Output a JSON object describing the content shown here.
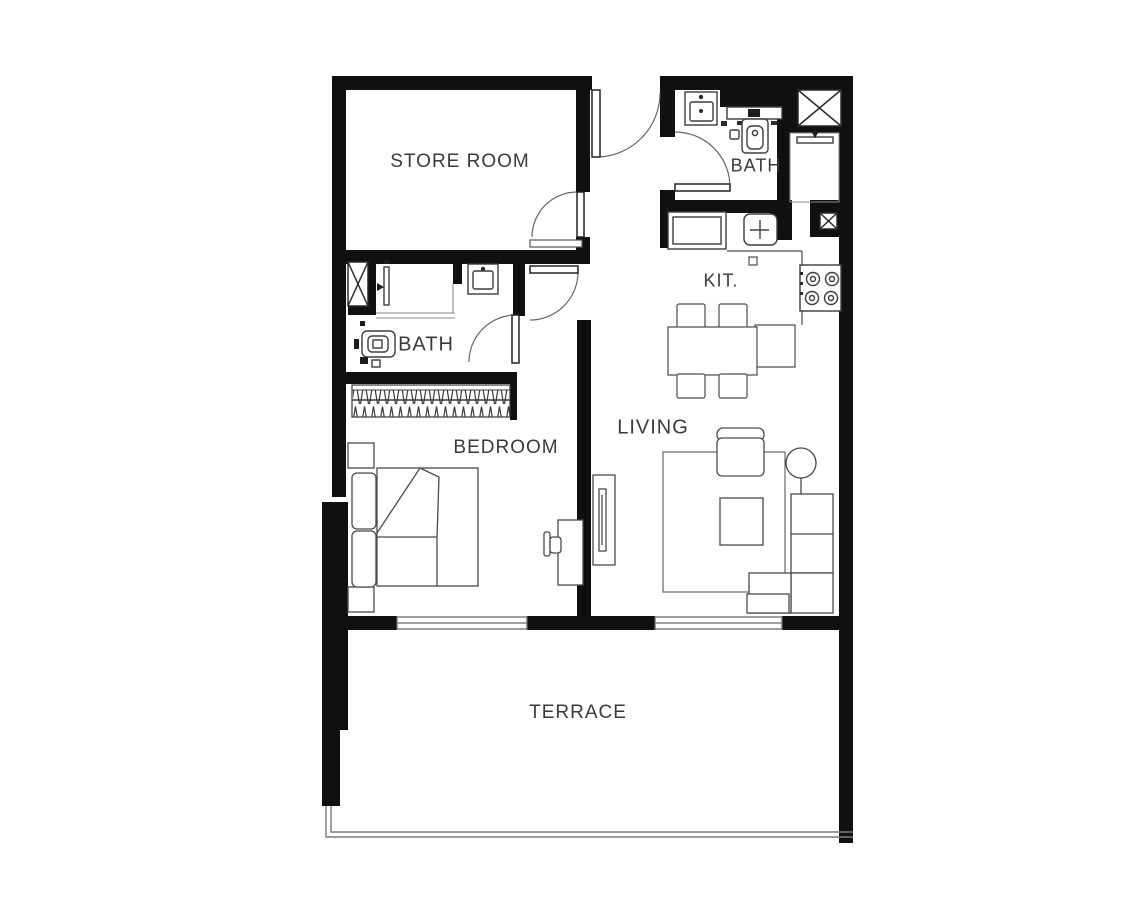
{
  "title": "Apartment floor plan",
  "rooms": [
    {
      "id": "store-room",
      "label": "STORE ROOM"
    },
    {
      "id": "bath-top",
      "label": "BATH"
    },
    {
      "id": "kitchen",
      "label": "KIT."
    },
    {
      "id": "bath-left",
      "label": "BATH"
    },
    {
      "id": "bedroom",
      "label": "BEDROOM"
    },
    {
      "id": "living",
      "label": "LIVING"
    },
    {
      "id": "terrace",
      "label": "TERRACE"
    }
  ],
  "fixtures": [
    "entrance-door",
    "store-room-door",
    "corridor-door",
    "bath-left-door",
    "bath-top-door",
    "sink",
    "toilet",
    "shower",
    "shaft",
    "wardrobe",
    "bed",
    "pillows",
    "nightstand",
    "desk",
    "desk-chair",
    "tv-unit",
    "rug",
    "armchair",
    "floor-lamp",
    "sofa",
    "coffee-table",
    "fridge",
    "kitchen-sink",
    "stove",
    "counter",
    "dining-table",
    "dining-chair",
    "window",
    "railing"
  ],
  "colors": {
    "background": "#ffffff",
    "wall": "#101010",
    "furniture_line": "#4a4a4a",
    "door_arc": "#666666",
    "label_text": "#3a3a3a"
  }
}
